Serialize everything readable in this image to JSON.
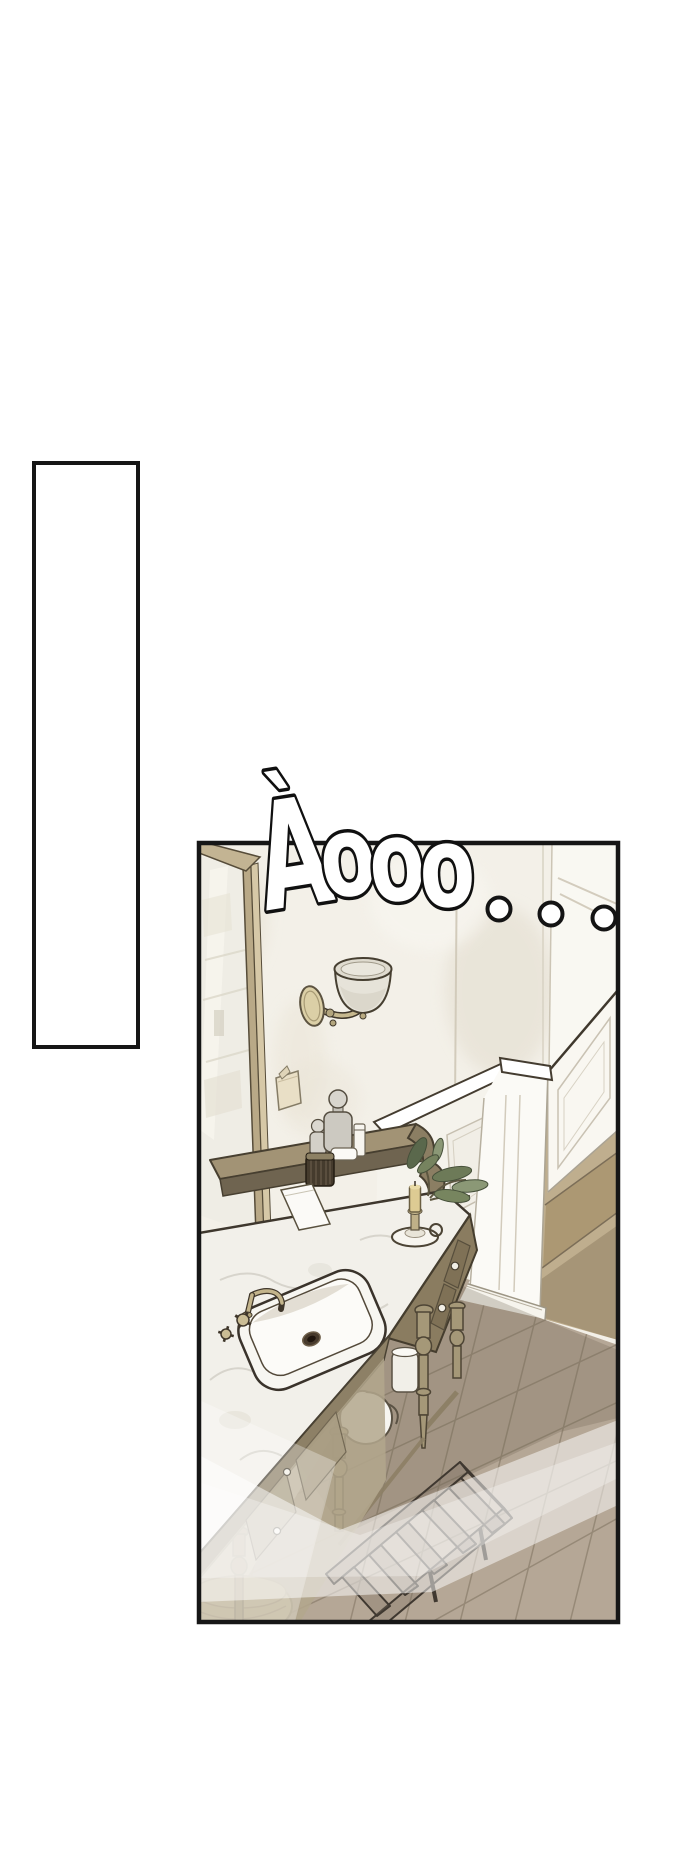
{
  "page": {
    "background": "#ffffff",
    "width": 700,
    "height": 1865
  },
  "speech_bubble": {
    "text": "",
    "fill": "#ffffff",
    "border": "#161616"
  },
  "panel": {
    "border": "#161616"
  },
  "sfx": {
    "text": "Àooo",
    "letters": [
      "À",
      "o",
      "o",
      "o"
    ],
    "dot_count": 3,
    "fill": "#ffffff",
    "outline": "#101010"
  },
  "scene": {
    "setting": "classic bathroom interior seen from above",
    "objects": [
      "framed mirror",
      "wall sconce",
      "note on wall",
      "wainscot half-wall",
      "corner pillar",
      "wooden steps",
      "marble-top vanity",
      "sink with brass faucet",
      "glass bottles",
      "ribbed jar",
      "white book",
      "candlestick",
      "leafy sprig",
      "herringbone floor",
      "slatted chair",
      "round stool",
      "light beam"
    ],
    "palette": {
      "wall": "#f3f0e8",
      "wall_shadow": "#e4ded0",
      "mirror_frame": "#c3b493",
      "mirror_glass": "#efede5",
      "sconce_brass": "#c6b88e",
      "sconce_cup": "#e6e3d9",
      "wainscot": "#f6f4ee",
      "steps_wood": "#bfae8e",
      "vanity_wood": "#8d8066",
      "vanity_dark": "#6f6450",
      "marble": "#f2f0ea",
      "marble_vein": "#d5d2c9",
      "leaf_dark": "#5a684c",
      "leaf_light": "#8b9876",
      "candle": "#ddcb93",
      "floor": "#b5a796",
      "floor_shadow": "#8f8271",
      "chair": "#7c6c60",
      "stool": "#ead9aa",
      "light_beam": "#ffffff",
      "outline": "#3e372d"
    }
  }
}
